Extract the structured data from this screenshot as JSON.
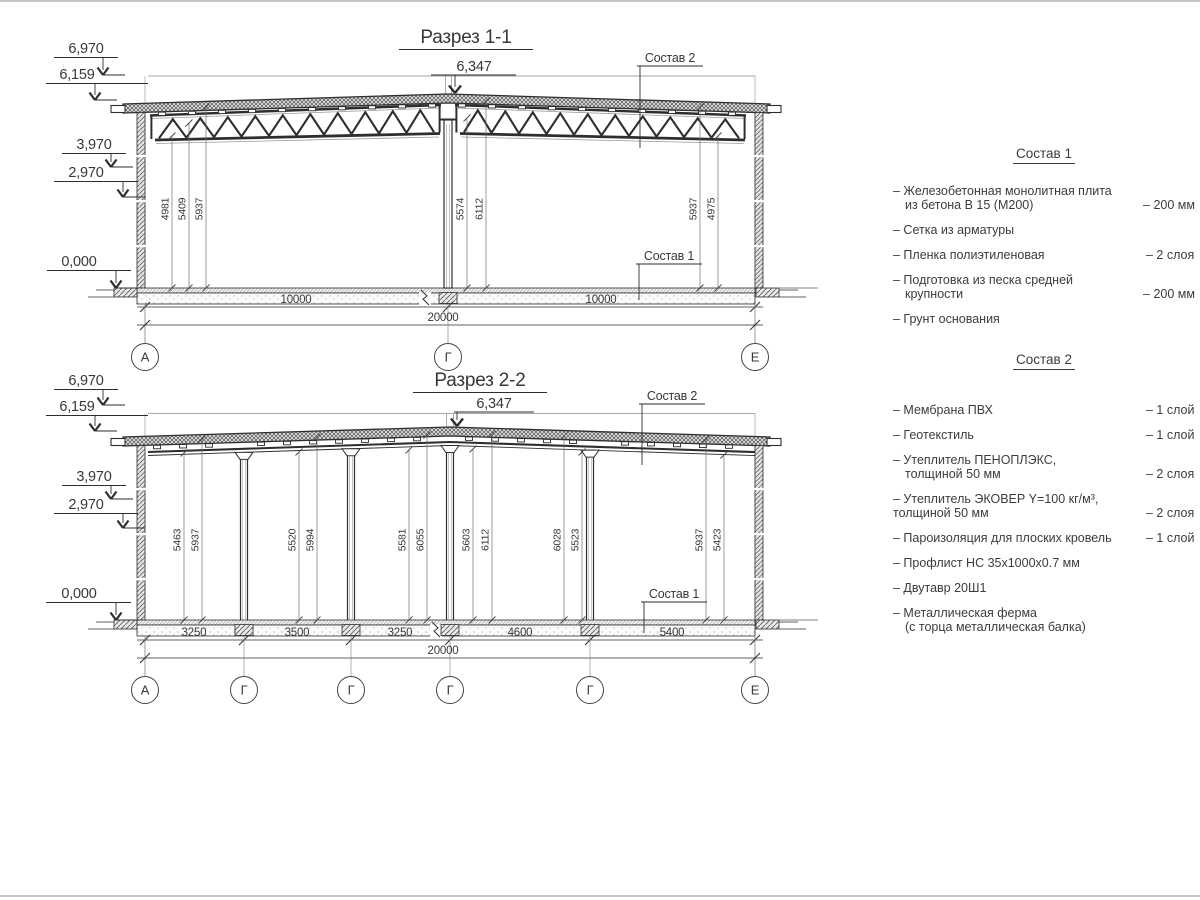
{
  "ink": "#2e2e2e",
  "section1": {
    "title": "Разрез 1-1",
    "ridge_elevation": "6,347",
    "elevations": [
      "6,970",
      "6,159",
      "3,970",
      "2,970",
      "0,000"
    ],
    "callout_roof": "Состав 2",
    "callout_floor": "Состав 1",
    "interior_dims": [
      "4981",
      "5409",
      "5937",
      "5574",
      "6112",
      "5937",
      "4975"
    ],
    "span_dims": [
      "10000",
      "10000"
    ],
    "total_dim": "20000",
    "axes": [
      "А",
      "Г",
      "Е"
    ]
  },
  "section2": {
    "title": "Разрез 2-2",
    "ridge_elevation": "6,347",
    "elevations": [
      "6,970",
      "6,159",
      "3,970",
      "2,970",
      "0,000"
    ],
    "callout_roof": "Состав 2",
    "callout_floor": "Состав 1",
    "interior_dims": [
      "5463",
      "5937",
      "5520",
      "5994",
      "5581",
      "6055",
      "5603",
      "6112",
      "6028",
      "5523",
      "5937",
      "5423"
    ],
    "span_dims": [
      "3250",
      "3500",
      "3250",
      "4600",
      "5400"
    ],
    "total_dim": "20000",
    "axes": [
      "А",
      "Г",
      "Г",
      "Г",
      "Г",
      "Е"
    ]
  },
  "legend1": {
    "title": "Состав 1",
    "items": [
      {
        "name": "– Железобетонная монолитная плита",
        "name2": "из бетона В 15 (М200)",
        "value": "– 200 мм"
      },
      {
        "name": "– Сетка из арматуры",
        "value": ""
      },
      {
        "name": "– Пленка полиэтиленовая",
        "value": "– 2 слоя"
      },
      {
        "name": "– Подготовка из песка средней",
        "name2": "крупности",
        "value": "– 200 мм"
      },
      {
        "name": "– Грунт основания",
        "value": ""
      }
    ]
  },
  "legend2": {
    "title": "Состав 2",
    "items": [
      {
        "name": "– Мембрана ПВХ",
        "value": "– 1 слой"
      },
      {
        "name": "– Геотекстиль",
        "value": "– 1 слой"
      },
      {
        "name": "– Утеплитель ПЕНОПЛЭКС,",
        "name2": "толщиной 50 мм",
        "value": "– 2 слоя"
      },
      {
        "name": "– Утеплитель ЭКОВЕР Y=100 кг/м³,",
        "name2": "толщиной 50 мм",
        "value": "– 2 слоя"
      },
      {
        "name": "– Пароизоляция для плоских кровель",
        "value": "– 1 слой"
      },
      {
        "name": "– Профлист НС 35х1000х0.7 мм",
        "value": ""
      },
      {
        "name": "– Двутавр 20Ш1",
        "value": ""
      },
      {
        "name": "– Металлическая ферма",
        "name2": "(с торца металлическая балка)",
        "value": ""
      }
    ]
  }
}
